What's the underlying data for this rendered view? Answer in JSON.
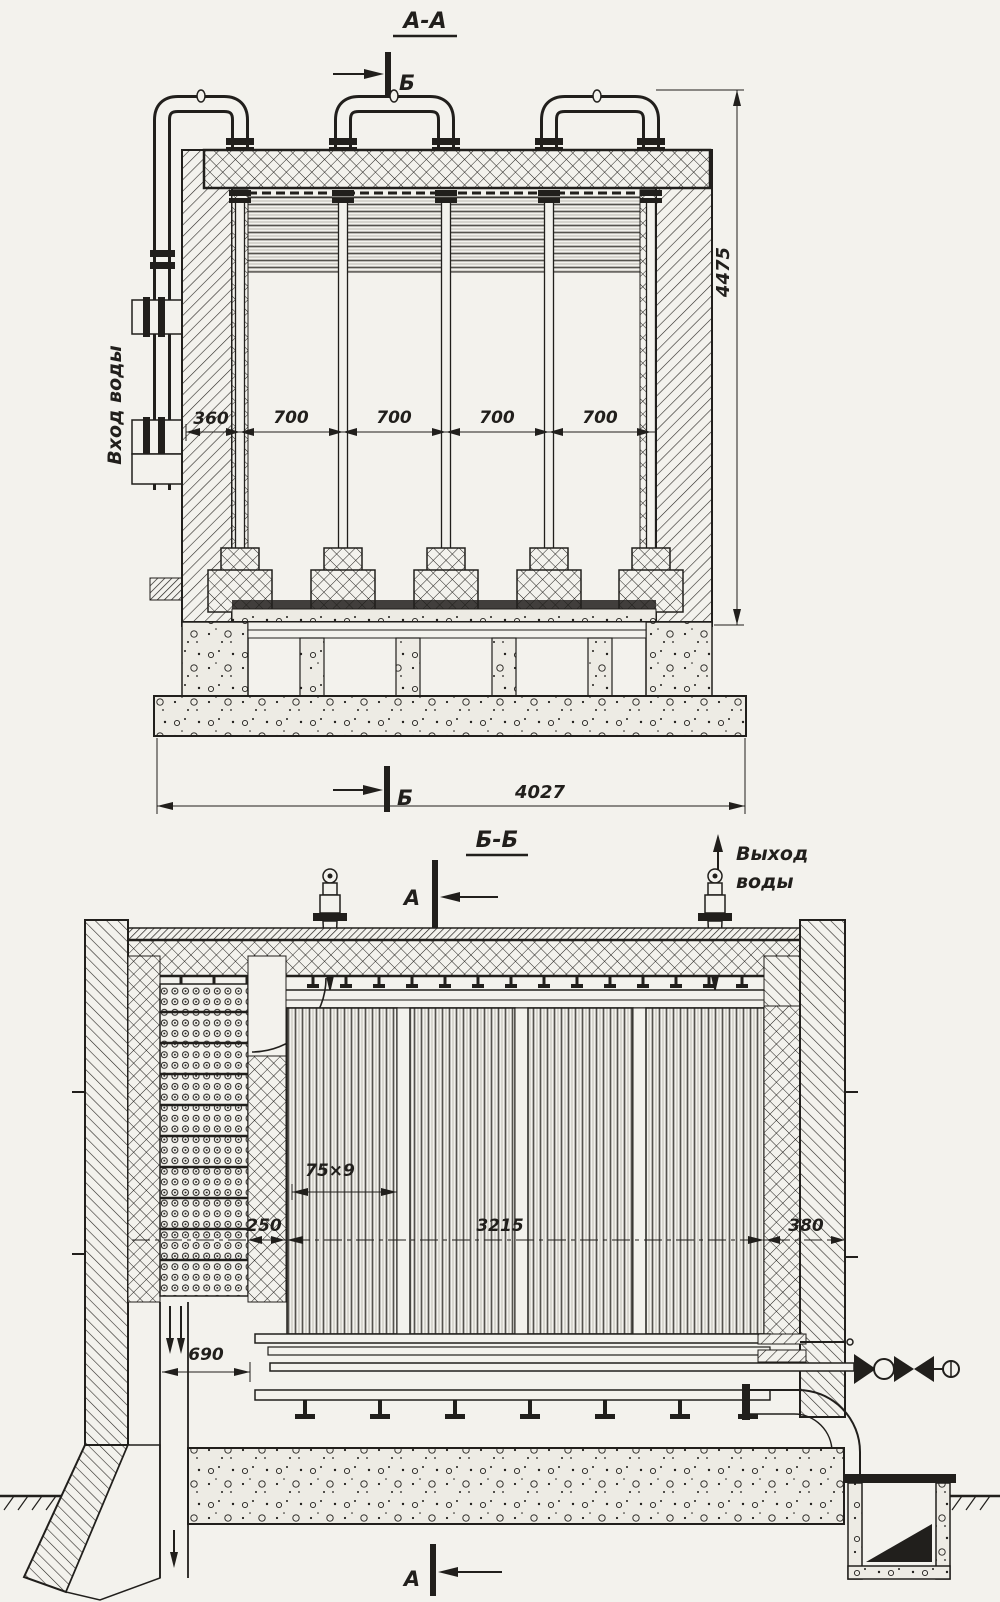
{
  "meta": {
    "paper_color": "#f3f2ed",
    "ink_color": "#211f1c"
  },
  "views": {
    "aa": {
      "title": "А-А",
      "cut_top": "Б",
      "cut_bottom": "Б",
      "inlet_label": "Вход воды",
      "dim_height": "4475",
      "dim_total_width": "4027",
      "dim_first_bay": "360",
      "bays": [
        "700",
        "700",
        "700",
        "700"
      ]
    },
    "bb": {
      "title": "Б-Б",
      "cut_top": "А",
      "cut_bottom": "А",
      "outlet_label_line1": "Выход",
      "outlet_label_line2": "воды",
      "dim_tube": "75×9",
      "dim_left_gap": "250",
      "dim_inner_span": "3215",
      "dim_right_gap": "380",
      "dim_flue": "690"
    }
  }
}
